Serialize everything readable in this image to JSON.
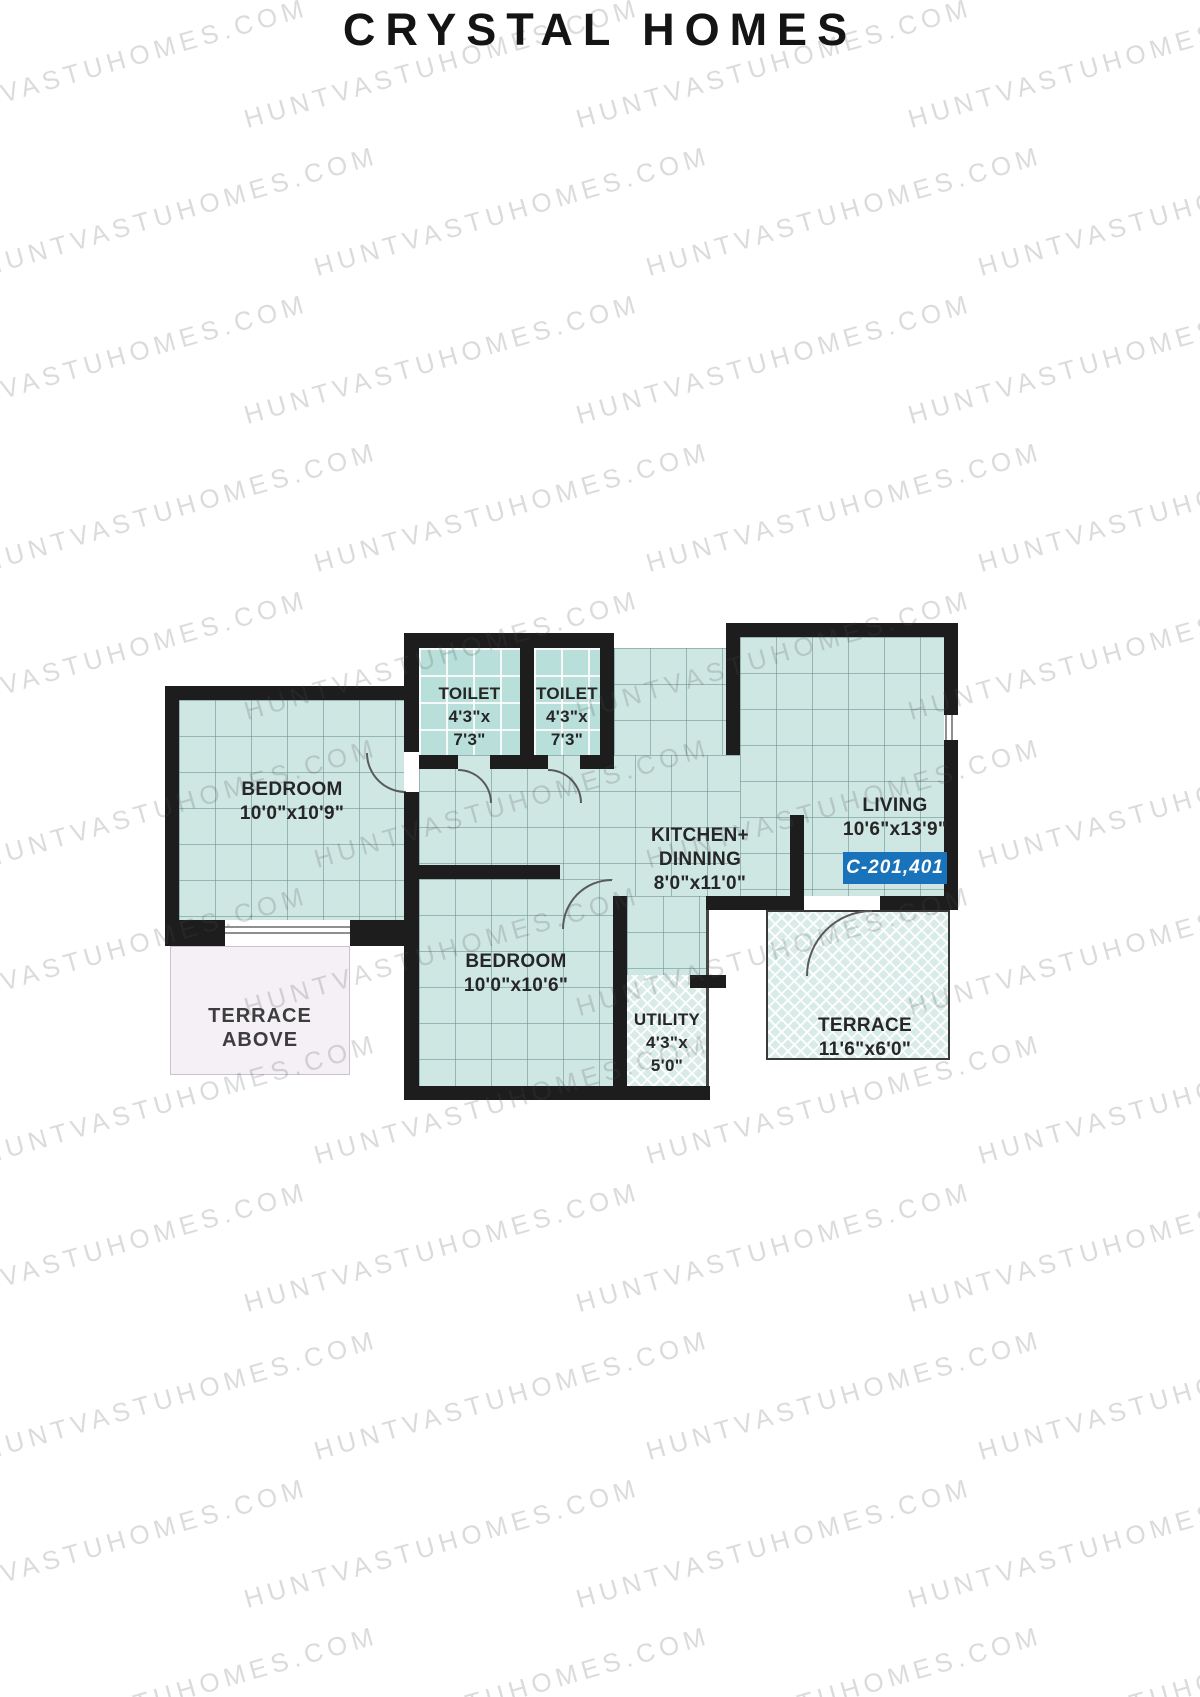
{
  "title": "CRYSTAL HOMES",
  "watermark": {
    "text": "HUNTVASTUHOMES.COM"
  },
  "floor_plan": {
    "unit_badge": {
      "label": "C-201,401"
    },
    "rooms": {
      "bedroom1": {
        "name": "BEDROOM",
        "dims": "10'0\"x10'9\""
      },
      "toilet1": {
        "name": "TOILET",
        "dims_w": "4'3\"x",
        "dims_h": "7'3\""
      },
      "toilet2": {
        "name": "TOILET",
        "dims_w": "4'3\"x",
        "dims_h": "7'3\""
      },
      "kitchen": {
        "name_line1": "KITCHEN+",
        "name_line2": "DINNING",
        "dims": "8'0\"x11'0\""
      },
      "living": {
        "name": "LIVING",
        "dims": "10'6\"x13'9\""
      },
      "bedroom2": {
        "name": "BEDROOM",
        "dims": "10'0\"x10'6\""
      },
      "terrace_above": {
        "name_line1": "TERRACE",
        "name_line2": "ABOVE"
      },
      "utility": {
        "name": "UTILITY",
        "dims_w": "4'3\"x",
        "dims_h": "5'0\""
      },
      "terrace": {
        "name": "TERRACE",
        "dims": "11'6\"x6'0\""
      }
    }
  },
  "colors": {
    "wall": "#1d1d1d",
    "room_fill": "#cfe7e3",
    "toilet_fill": "#b9dfda",
    "terrace_fill": "#d8ebe8",
    "terrace_above_fill": "#f4f0f6",
    "badge_background": "#1873ba",
    "badge_text": "#ffffff"
  }
}
